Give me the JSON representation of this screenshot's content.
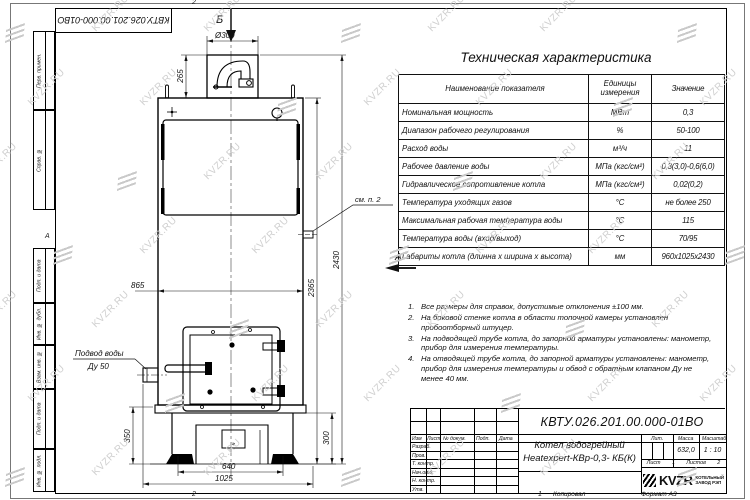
{
  "watermark": {
    "text": "KVZR.RU"
  },
  "frame": {
    "flipped_number": "КВТУ.026.201.00.000-01ВО",
    "margin_fields": [
      "Перв. примен.",
      "Справ. №",
      "Подп. и дата",
      "Инв. № дубл.",
      "Взам. инв. №",
      "Подп. и дата",
      "Инв. № подл."
    ],
    "zone_top": "2",
    "zone_bottom_left": "2",
    "zone_bottom_right": "1",
    "zone_left": "А"
  },
  "spec_table": {
    "title": "Техническая характеристика",
    "headers": [
      "Наименование показателя",
      "Единицы измерения",
      "Значение"
    ],
    "rows": [
      {
        "name": "Номинальная мощность",
        "unit": "МВт",
        "value": "0,3"
      },
      {
        "name": "Диапазон рабочего регулирования",
        "unit": "%",
        "value": "50-100"
      },
      {
        "name": "Расход воды",
        "unit": "м³/ч",
        "value": "11"
      },
      {
        "name": "Рабочее давление воды",
        "unit": "МПа (кгс/см²)",
        "value": "0,3(3,0)-0,6(6,0)"
      },
      {
        "name": "Гидравлическое сопротивление котла",
        "unit": "МПа (кгс/см²)",
        "value": "0,02(0,2)"
      },
      {
        "name": "Температура уходящих газов",
        "unit": "°С",
        "value": "не более 250"
      },
      {
        "name": "Максимальная рабочая температура воды",
        "unit": "°С",
        "value": "115"
      },
      {
        "name": "Температура воды (вход/выход)",
        "unit": "°С",
        "value": "70/95"
      },
      {
        "name": "Габариты котла (длинна х ширина х высота)",
        "unit": "мм",
        "value": "960х1025х2430"
      }
    ]
  },
  "notes": {
    "items": [
      {
        "num": "1.",
        "text": "Все размеры для справок, допустимые отклонения ±100 мм."
      },
      {
        "num": "2.",
        "text": "На боковой стенке котла в области топочной камеры установлен пробоотборный штуцер."
      },
      {
        "num": "3.",
        "text": "На подводящей трубе котла, до запорной арматуры установлены: манометр, прибор для измерения температуры."
      },
      {
        "num": "4.",
        "text": "На отводящей трубе котла, до запорной арматуры установлены: манометр, прибор для измерения температуры и обвод с обратным клапаном Ду не менее 40 мм."
      }
    ]
  },
  "title_block": {
    "doc_number": "КВТУ.026.201.00.000-01ВО",
    "product_name_line1": "Котел водогрейный",
    "product_name_line2": "Heatexpert-КВр-0,3- КБ(К)",
    "rev_headers": [
      "Изм",
      "Лист",
      "№ докум.",
      "Подп.",
      "Дата"
    ],
    "role_rows": [
      "Разраб.",
      "Пров.",
      "Т. контр.",
      "Нач.отд.",
      "Н. контр.",
      "Утв."
    ],
    "lit_label": "Лит.",
    "mass_label": "Масса",
    "scale_label": "Масштаб",
    "mass_value": "632,0",
    "scale_value": "1 : 10",
    "sheet_label": "Лист",
    "sheet_value": "1",
    "sheets_label": "Листов",
    "sheets_value": "2",
    "logo_text": "KVZR",
    "logo_caption_line1": "КОТЕЛЬНЫЙ",
    "logo_caption_line2": "ЗАВОД РЭП",
    "footer_copy": "Копировал",
    "footer_format": "Формат А3"
  },
  "drawing": {
    "view_top_label": "Б",
    "view_side_label": "А",
    "dim_diameter": "Ø300",
    "dim_chimney_h": "265",
    "dim_body_w": "865",
    "dim_total_h": "2430",
    "dim_body_h": "2365",
    "dim_base_left_h": "350",
    "dim_base_right_h": "300",
    "dim_opening_w": "640",
    "dim_base_w": "1025",
    "callout_see_note": "см. п. 2",
    "callout_water_line1": "Подвод воды",
    "callout_water_line2": "Ду 50"
  }
}
